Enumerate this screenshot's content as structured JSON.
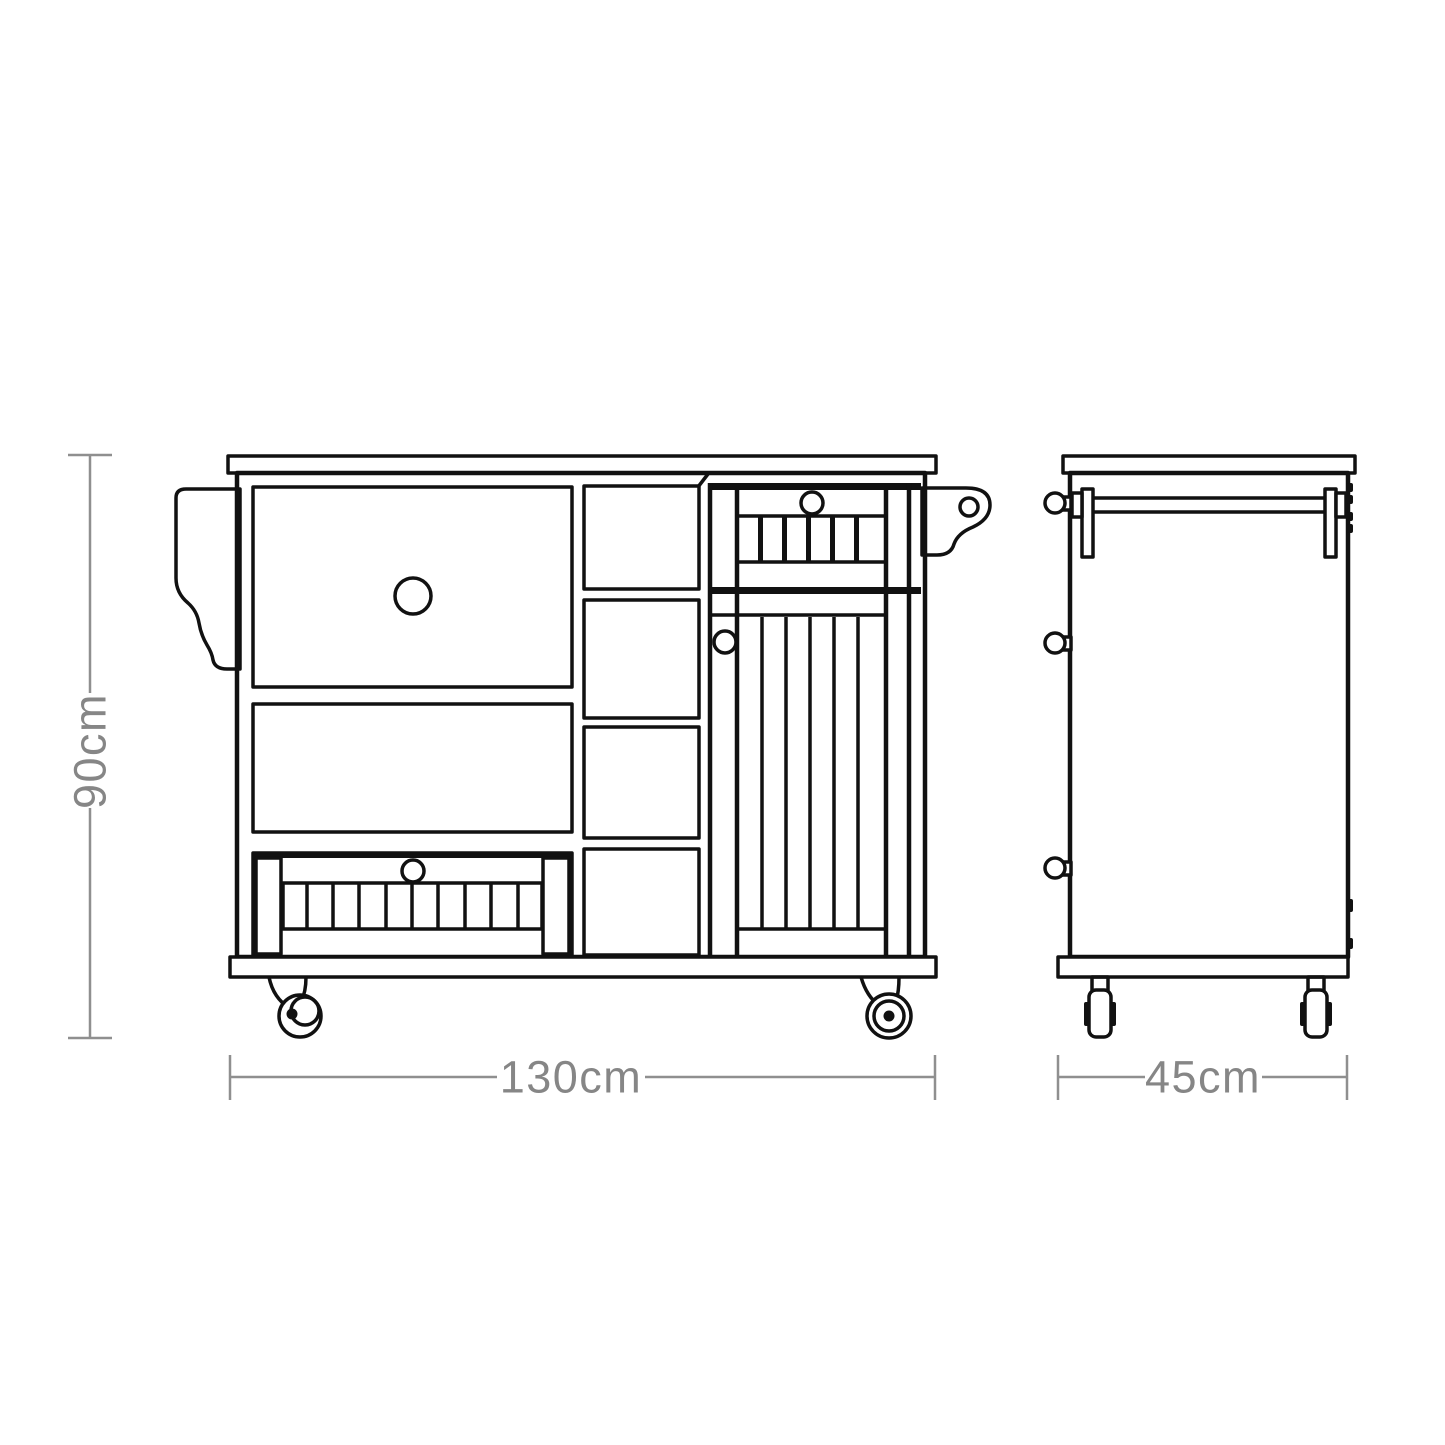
{
  "colors": {
    "line": "#111111",
    "fill": "#ffffff",
    "dimension_line": "#8f8f8f",
    "dimension_text": "#868686",
    "background": "#ffffff"
  },
  "dimensions": {
    "height": {
      "label": "90cm"
    },
    "width": {
      "label": "130cm"
    },
    "depth": {
      "label": "45cm"
    }
  }
}
